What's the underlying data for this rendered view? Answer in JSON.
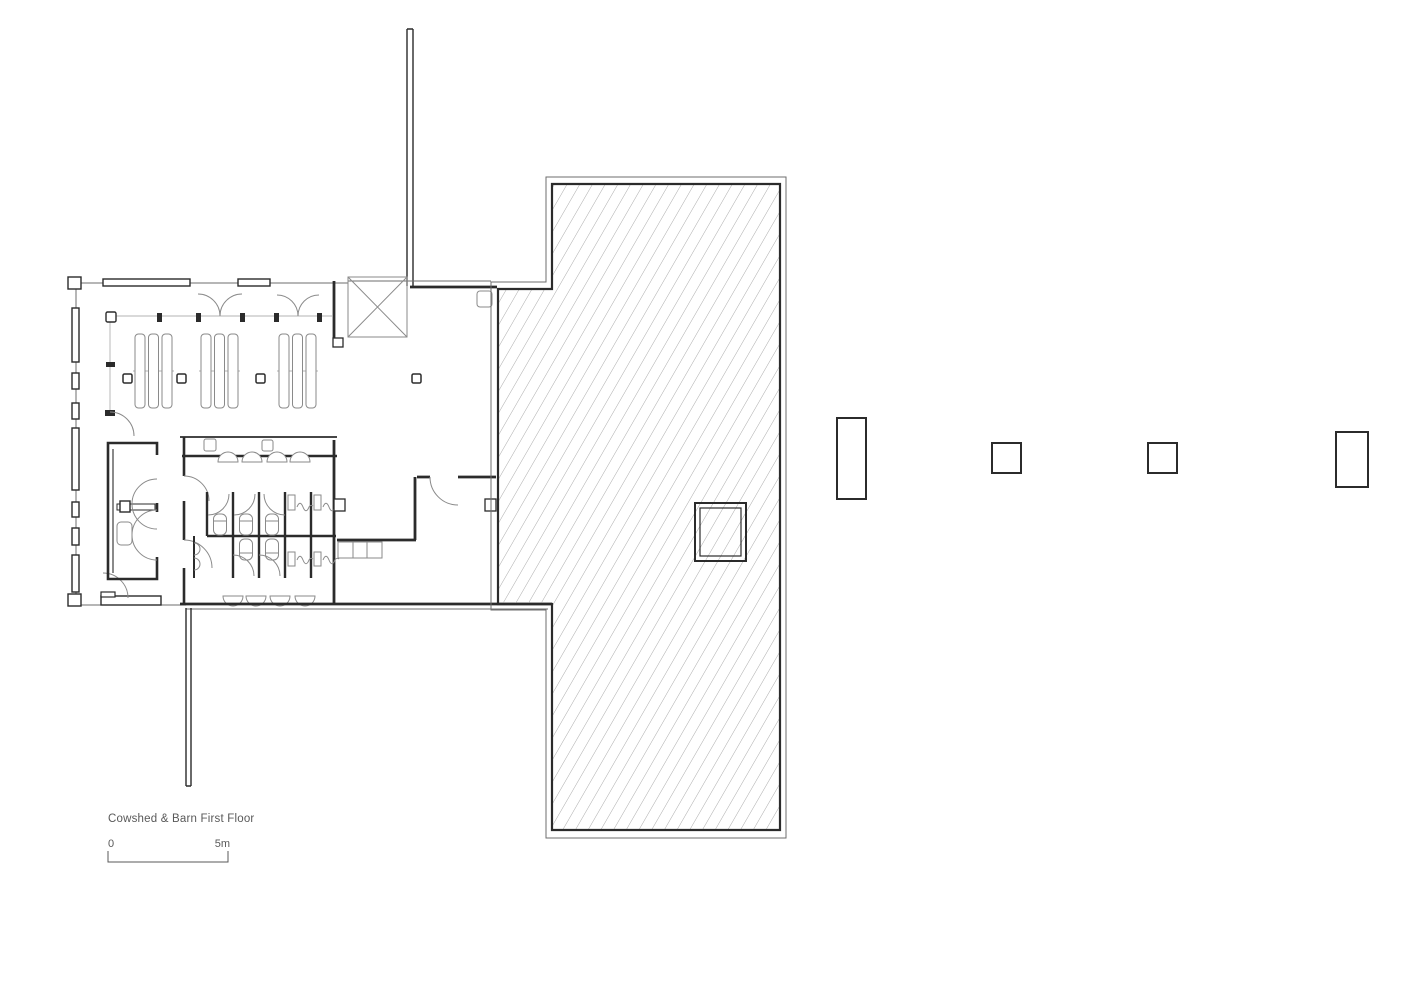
{
  "title_block": {
    "title": "Cowshed & Barn First Floor",
    "scale_zero_label": "0",
    "scale_max_label": "5m"
  },
  "colors": {
    "wall": "#2b2b2b",
    "outline": "#6e6e6e",
    "fixture": "#8a8a8a",
    "light": "#b3b3b3",
    "hatch": "#ababab",
    "text": "#595959",
    "bg": "#ffffff"
  }
}
